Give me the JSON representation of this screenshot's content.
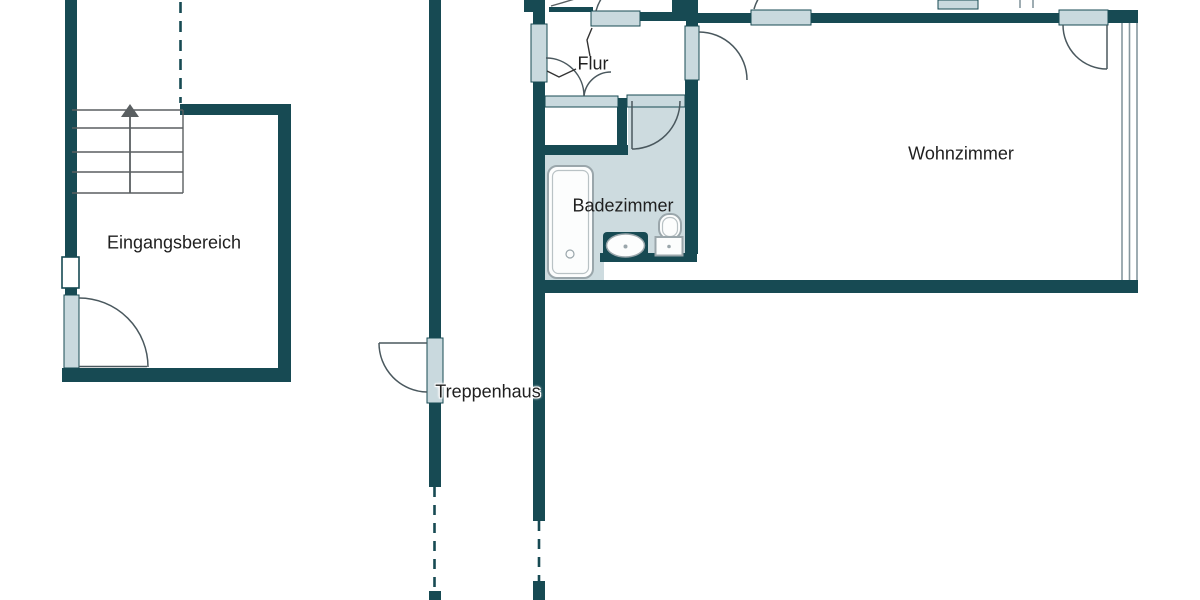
{
  "floorplan": {
    "rooms": [
      {
        "id": "eingangsbereich",
        "label": "Eingangsbereich"
      },
      {
        "id": "treppenhaus",
        "label": "Treppenhaus"
      },
      {
        "id": "flur",
        "label": "Flur"
      },
      {
        "id": "badezimmer",
        "label": "Badezimmer"
      },
      {
        "id": "wohnzimmer",
        "label": "Wohnzimmer"
      }
    ],
    "fixtures": [
      {
        "name": "staircase"
      },
      {
        "name": "stairs-direction-arrow"
      },
      {
        "name": "bathtub"
      },
      {
        "name": "washbasin"
      },
      {
        "name": "toilet"
      }
    ],
    "colors": {
      "wall": "#174a53",
      "door_threshold": "#c9d9de",
      "bathroom_floor": "#cddbdf",
      "fixture_outline": "#9aa6ab",
      "line": "#4a585e",
      "stair_line": "#5a5f61",
      "window_line": "#86979e",
      "text": "#1f1f1f",
      "background": "#ffffff"
    }
  }
}
